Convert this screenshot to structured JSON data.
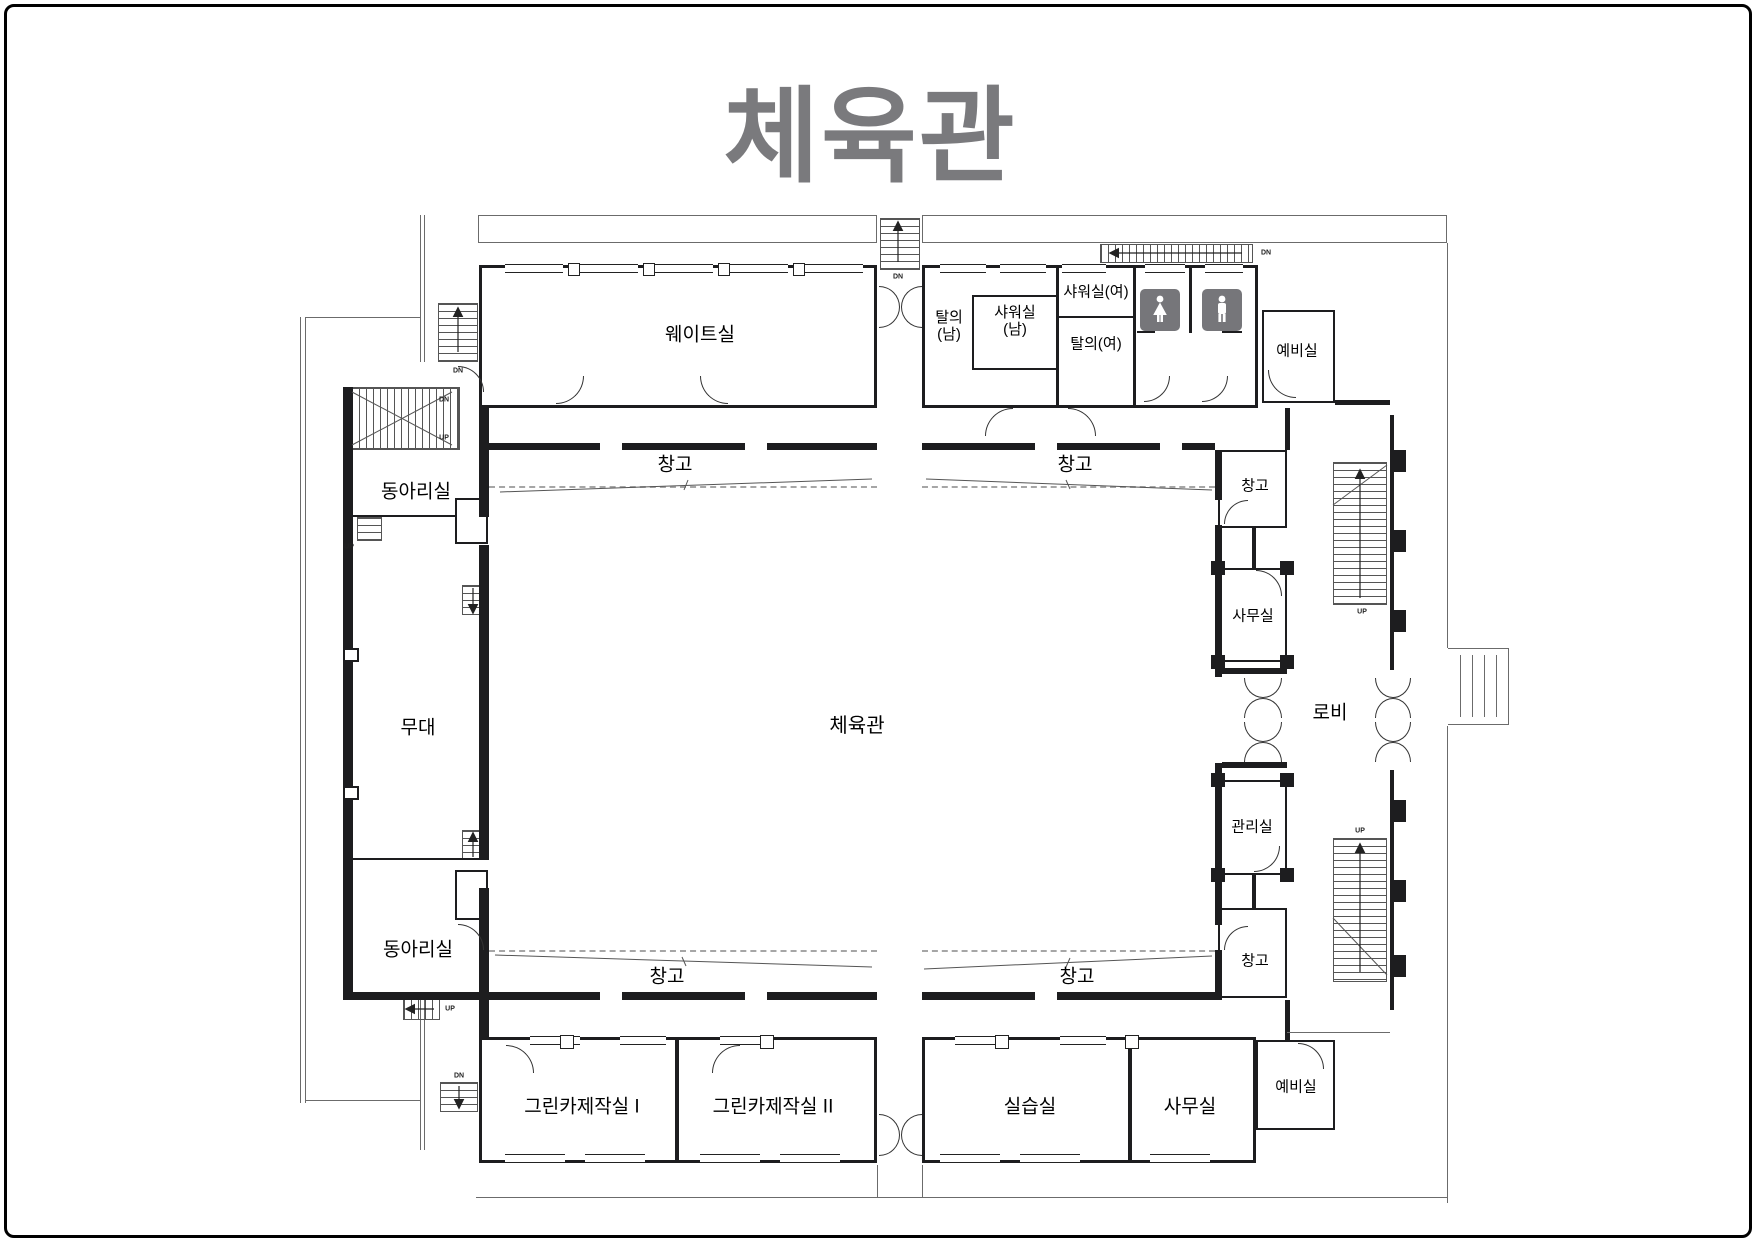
{
  "title": "체육관",
  "rooms": {
    "weight": "웨이트실",
    "changing_men": "탈의\n(남)",
    "shower_men": "샤워실\n(남)",
    "shower_women": "샤워실(여)",
    "changing_women": "탈의(여)",
    "reserve": "예비실",
    "club": "동아리실",
    "stage": "무대",
    "gym": "체육관",
    "storage": "창고",
    "office": "사무실",
    "admin": "관리실",
    "lobby": "로비",
    "greencar1": "그린카제작실 I",
    "greencar2": "그린카제작실 II",
    "practice": "실습실"
  },
  "stairs": {
    "up": "UP",
    "dn": "DN"
  },
  "icons": {
    "women_restroom": "women-restroom-icon",
    "men_restroom": "men-restroom-icon"
  },
  "colors": {
    "wall": "#1d1d1f",
    "line": "#6b6b6b",
    "title": "#7a7a7d",
    "icon_bg": "#76767a",
    "dash": "#a6a6a6"
  }
}
